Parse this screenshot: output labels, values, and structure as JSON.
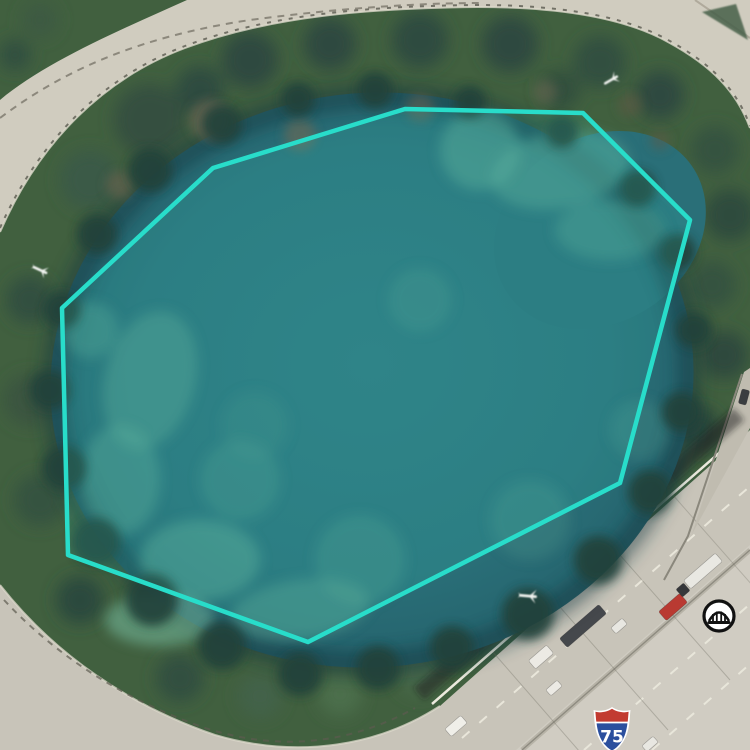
{
  "view": {
    "description": "satellite-imagery-with-parcel-overlay",
    "width": 750,
    "height": 750
  },
  "overlay": {
    "polygon_points": "213,168 405,109 583,113 690,220 620,483 308,642 68,555 62,308",
    "stroke_color": "#28ddca",
    "fill_color": "rgba(62,230,210,0.13)"
  },
  "markers": {
    "bridge_marker": {
      "icon": "bridge-icon",
      "x": 719,
      "y": 616
    },
    "route_shield": {
      "icon": "interstate-shield-icon",
      "number": "75",
      "x": 612,
      "y": 729
    }
  },
  "imagery": {
    "features": {
      "pond_color": "#2a6f78",
      "algae_color": "#62ab97",
      "tree_color": "#3f5c45",
      "ring_road_color": "#d0ccbf",
      "highway_color": "#c8c4b9",
      "plane_artifacts": 3,
      "vehicles_on_highway": 9
    }
  }
}
